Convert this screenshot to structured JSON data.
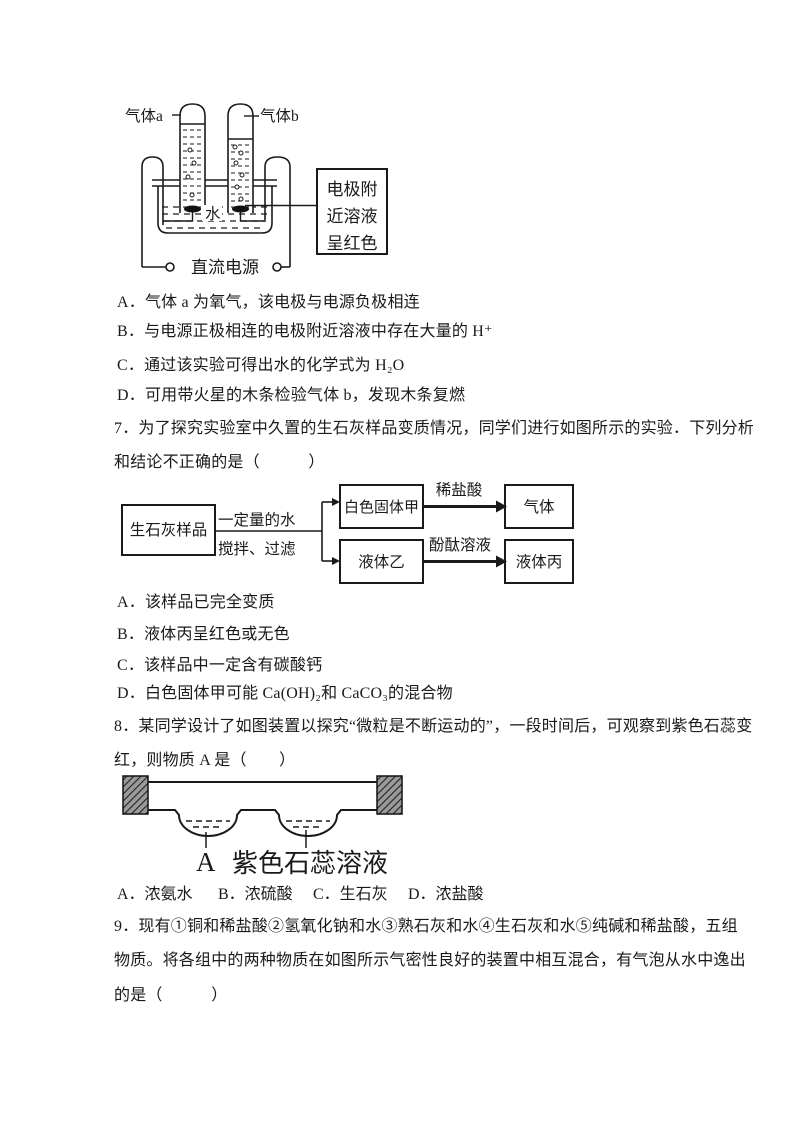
{
  "document": {
    "background": "#ffffff",
    "ink": "#1a1a1a"
  },
  "q6": {
    "figure": {
      "gas_a_label": "气体a",
      "gas_b_label": "气体b",
      "water_label": "水",
      "power_label": "直流电源",
      "note_lines": [
        "电极附",
        "近溶液",
        "呈红色"
      ]
    },
    "options": [
      "A．气体 a 为氧气，该电极与电源负极相连",
      "B．与电源正极相连的电极附近溶液中存在大量的 H⁺",
      "C．通过该实验可得出水的化学式为 H₂O",
      "D．可用带火星的木条检验气体 b，发现木条复燃"
    ]
  },
  "q7": {
    "stem": [
      "7．为了探究实验室中久置的生石灰样品变质情况，同学们进行如图所示的实验．下列分析",
      "和结论不正确的是（　　　）"
    ],
    "flowchart": {
      "sample_box": "生石灰样品",
      "process_line1": "一定量的水",
      "process_line2": "搅拌、过滤",
      "solid_box": "白色固体甲",
      "reagent_top": "稀盐酸",
      "gas_box": "气体",
      "liquid_b_box": "液体乙",
      "reagent_bottom": "酚酞溶液",
      "liquid_c_box": "液体丙"
    },
    "options": [
      "A．该样品已完全变质",
      "B．液体丙呈红色或无色",
      "C．该样品中一定含有碳酸钙",
      "D．白色固体甲可能 Ca(OH)₂和 CaCO₃的混合物"
    ]
  },
  "q8": {
    "stem": [
      "8．某同学设计了如图装置以探究“微粒是不断运动的”，一段时间后，可观察到紫色石蕊变",
      "红，则物质 A 是（　　）"
    ],
    "figure": {
      "substance_label": "A",
      "litmus_label": "紫色石蕊溶液"
    },
    "options": [
      "A．浓氨水",
      "B．浓硫酸",
      "C．生石灰",
      "D．浓盐酸"
    ]
  },
  "q9": {
    "stem": [
      "9．现有①铜和稀盐酸②氢氧化钠和水③熟石灰和水④生石灰和水⑤纯碱和稀盐酸，五组",
      "物质。将各组中的两种物质在如图所示气密性良好的装置中相互混合，有气泡从水中逸出",
      "的是（　　　）"
    ]
  }
}
